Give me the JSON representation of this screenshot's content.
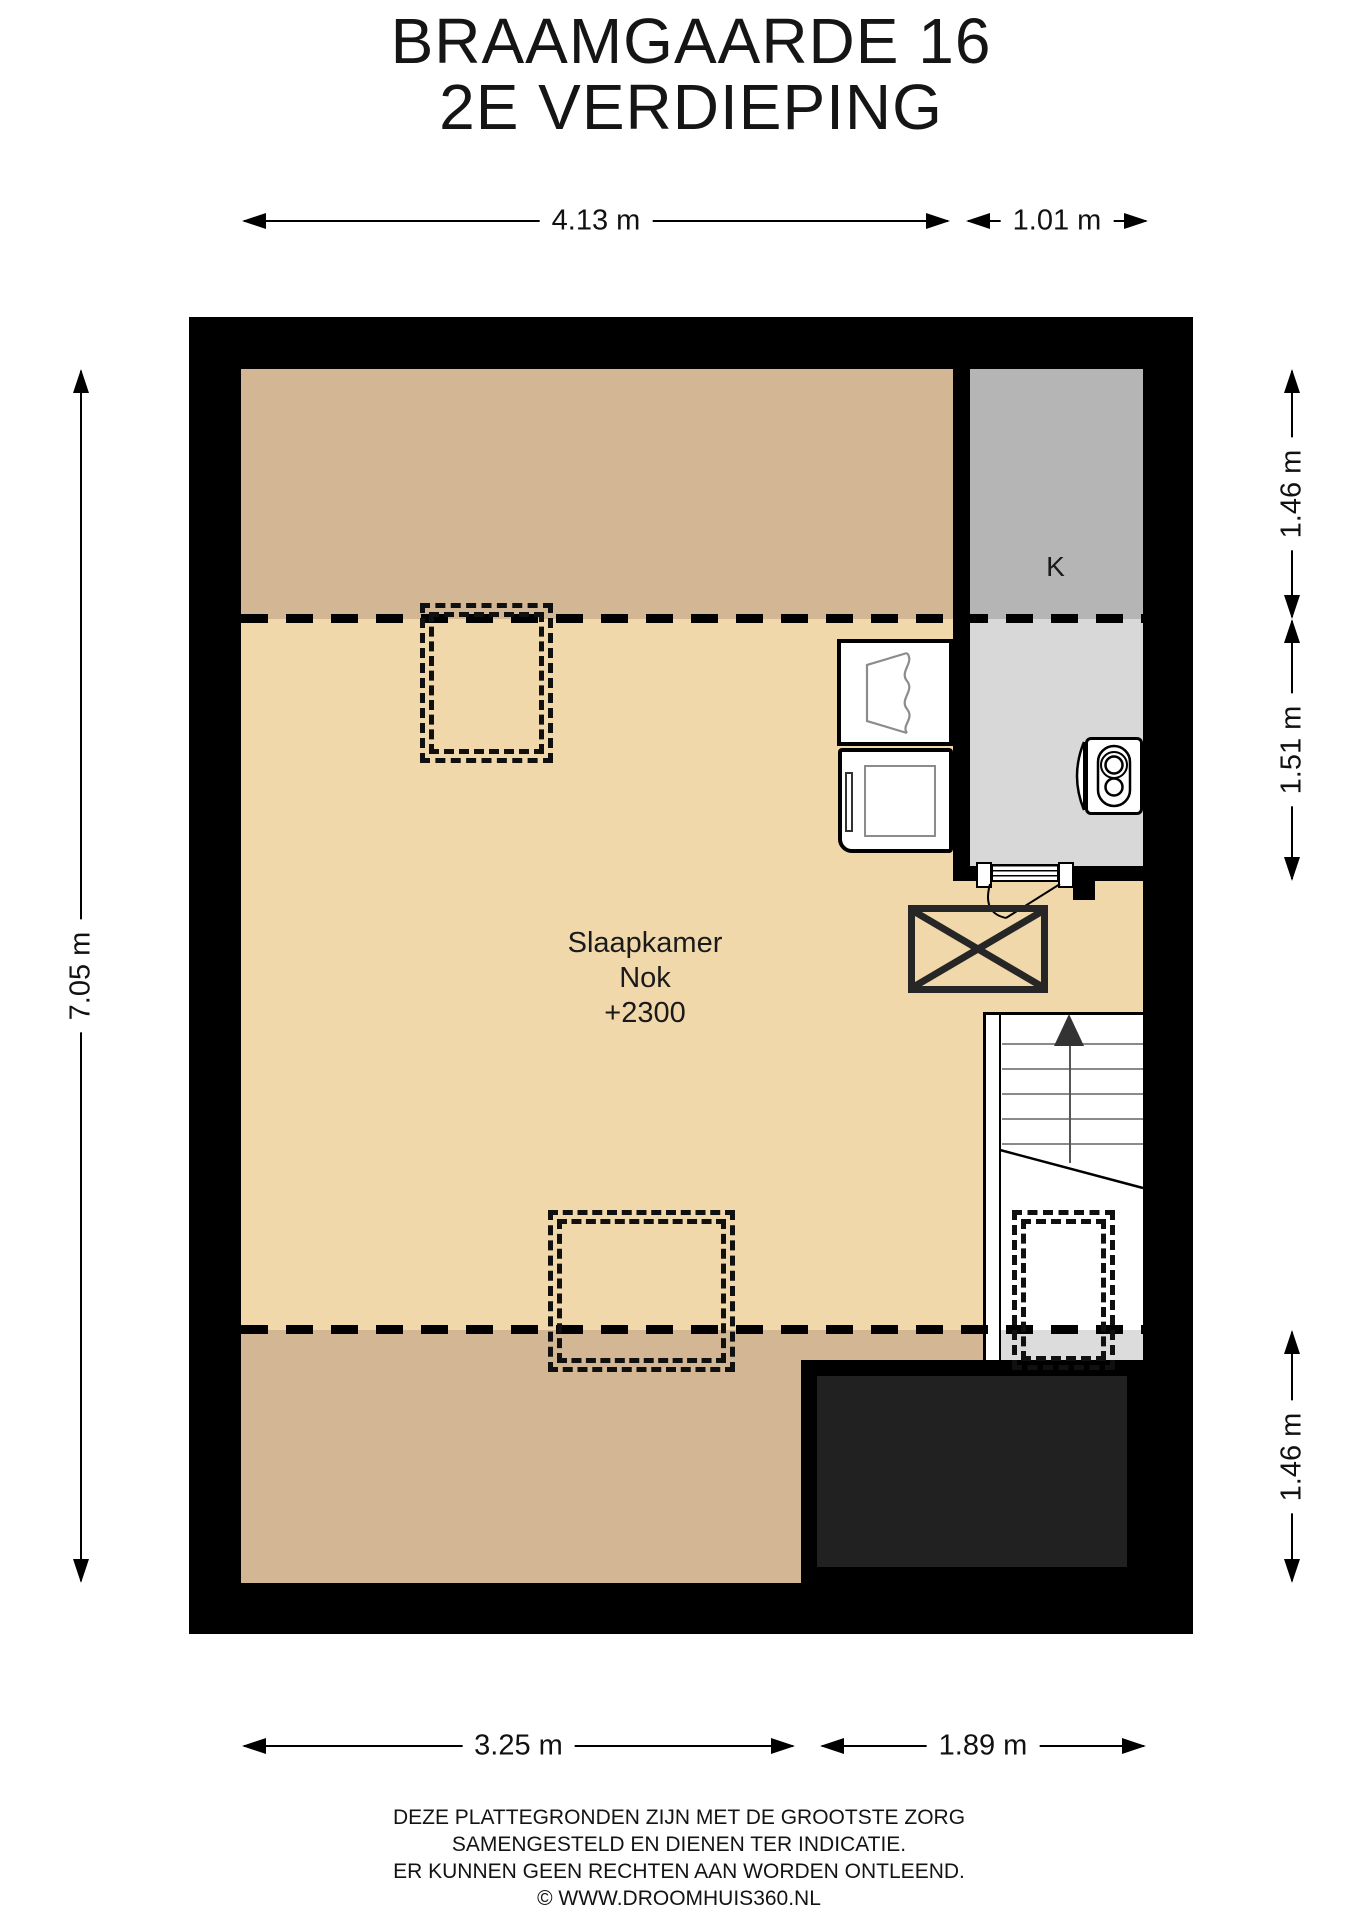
{
  "title": {
    "line1": "BRAAMGAARDE 16",
    "line2": "2E VERDIEPING"
  },
  "rooms": {
    "bedroom": {
      "name": "Slaapkamer",
      "ridge": "Nok",
      "ridge_value": "+2300"
    },
    "closet": "K"
  },
  "dims": {
    "top_main": "4.13 m",
    "top_right": "1.01 m",
    "left": "7.05 m",
    "right_top": "1.46 m",
    "right_mid": "1.51 m",
    "right_bottom": "1.46 m",
    "bottom_main": "3.25 m",
    "bottom_right": "1.89 m"
  },
  "footer": {
    "lines": [
      "DEZE PLATTEGRONDEN ZIJN MET DE GROOTSTE ZORG",
      "SAMENGESTELD EN DIENEN TER INDICATIE.",
      "ER KUNNEN GEEN RECHTEN AAN WORDEN ONTLEEND.",
      "© WWW.DROOMHUIS360.NL"
    ]
  },
  "colors": {
    "wall": "#000000",
    "floor_low_ceiling": "#d3b794",
    "floor_main": "#f0d8ab",
    "closet_upper": "#b5b5b5",
    "closet_lower": "#d8d8d8",
    "roof_void_fill": "#212121",
    "stair_strip": "#dcdcdc"
  }
}
